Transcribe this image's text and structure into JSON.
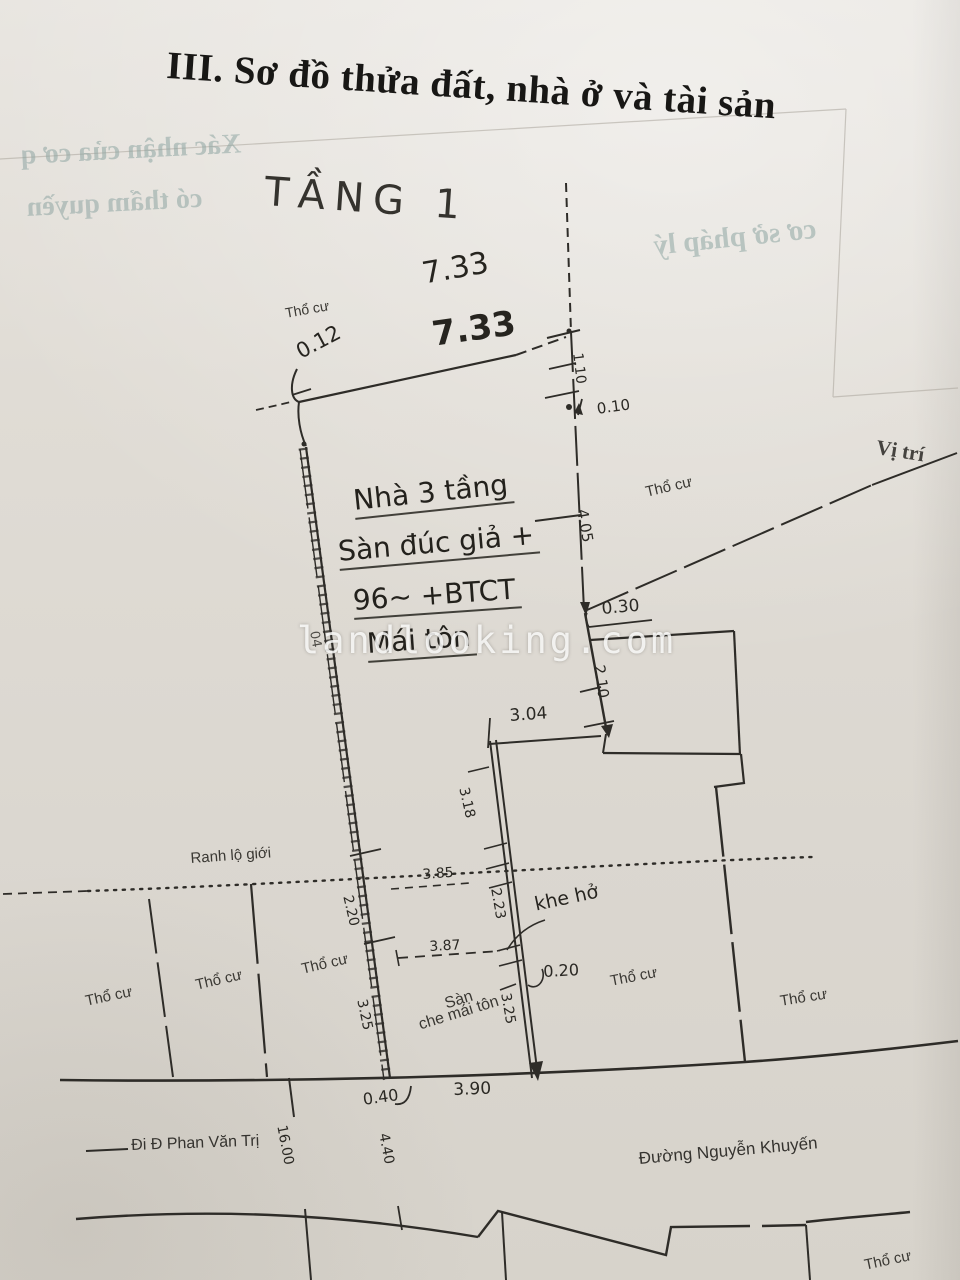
{
  "document": {
    "title": "III. Sơ đồ thửa đất, nhà ở và tài sản",
    "watermark": "landlooking.com"
  },
  "bleedthrough": {
    "confirm_line1": "Xác nhận của cơ q",
    "confirm_line2": "có thẩm quyền",
    "legal_basis": "cơ sở pháp lý"
  },
  "plan": {
    "floor_label": "TẦNG 1",
    "location_label": "Vị trí",
    "road_boundary_label": "Ranh lộ giới",
    "gap_label": "khe hở",
    "land_type_label": "Thổ cư",
    "house_note": {
      "line1": "Nhà 3 tầng",
      "line2": "Sàn đúc giả +",
      "line3": "96~ +BTCT",
      "line4": "Mái tôn"
    },
    "porch_note": {
      "line1": "Sàn",
      "line2": "che mái tôn"
    },
    "dimensions": {
      "top_edge_a": "7.33",
      "top_edge_b": "7.33",
      "d012": "0.12",
      "d110": "1.10",
      "d010": "0.10",
      "d405": "4.05",
      "d030": "0.30",
      "d210": "2.10",
      "d304": "3.04",
      "d318": "3.18",
      "d385": "3.85",
      "d223": "2.23",
      "d020": "0.20",
      "d387": "3.87",
      "d325_wall": "3.25",
      "d220": "2.20",
      "d325_left": "3.25",
      "d390": "3.90",
      "d040": "0.40",
      "d1600": "16.00",
      "d440": "4.40",
      "d04": "04"
    },
    "streets": {
      "left": "Đi Đ  Phan Văn Trị",
      "bottom": "Đường Nguyễn Khuyến"
    }
  }
}
